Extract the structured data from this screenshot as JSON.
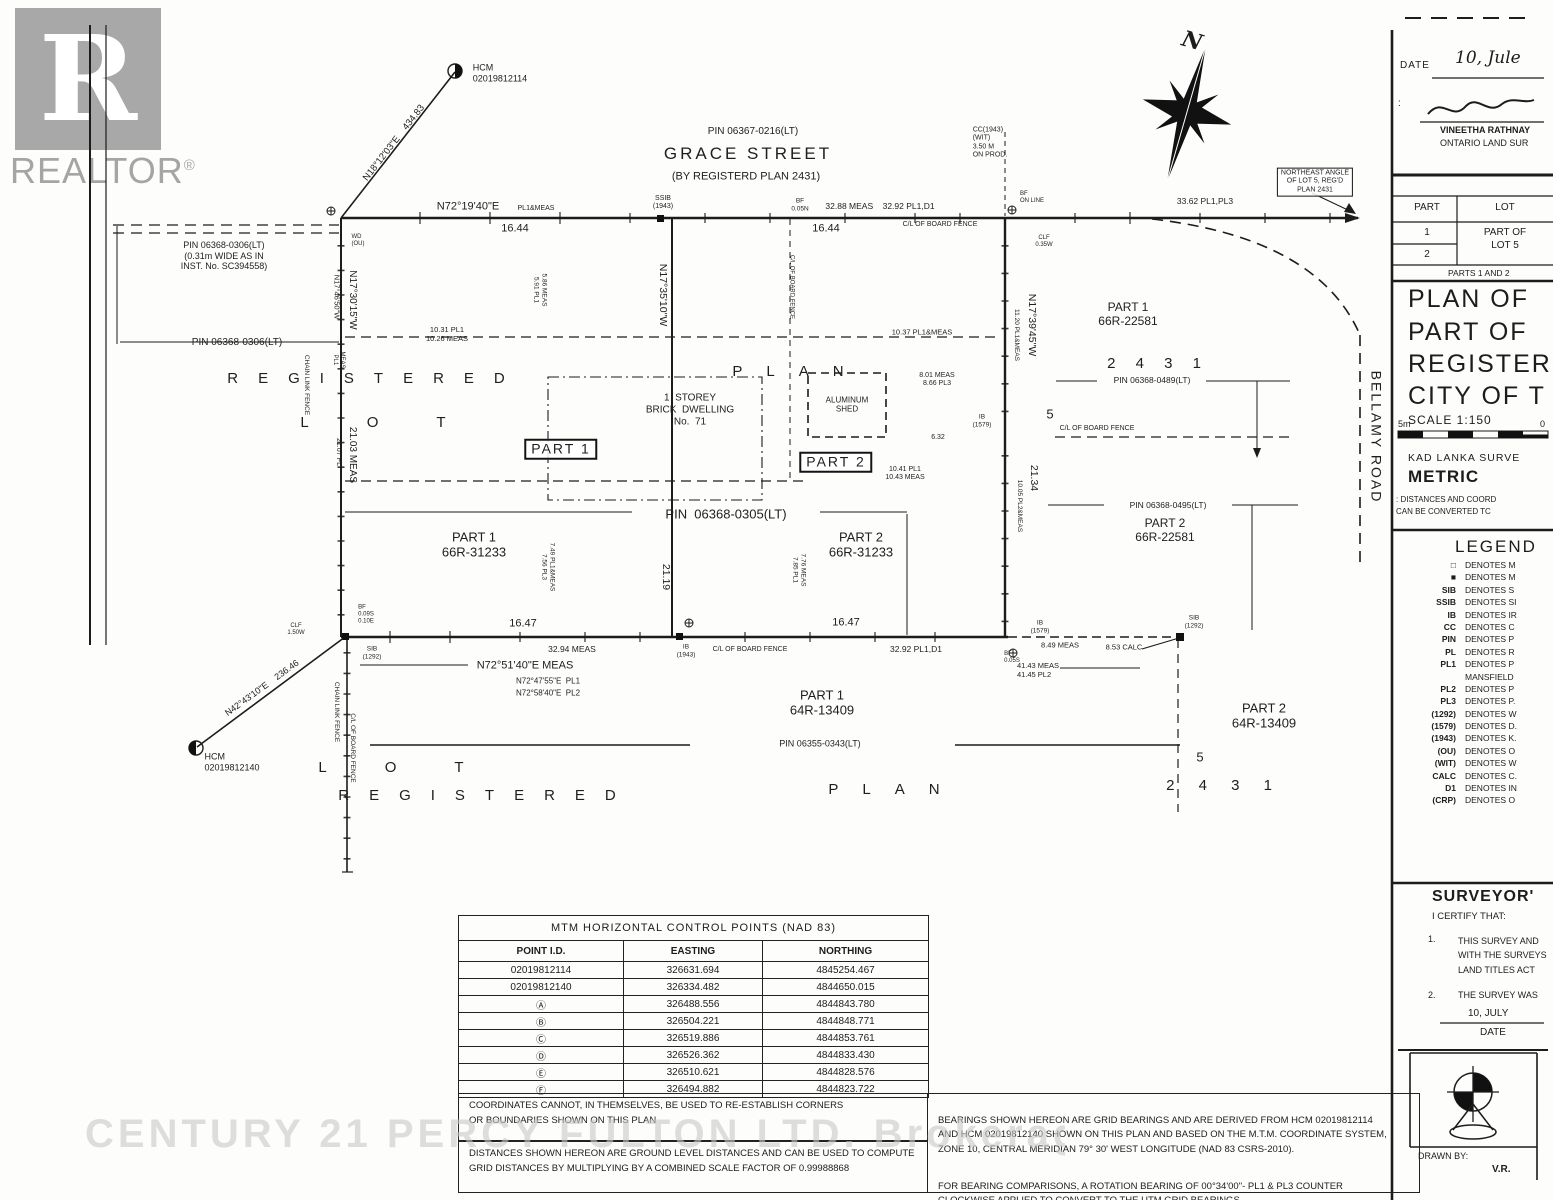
{
  "logo": {
    "r": "R",
    "brand": "REALTOR",
    "reg": "®"
  },
  "compass": {
    "north": "N"
  },
  "watermark": "CENTURY 21 PERCY FULTON LTD. Brokerage",
  "plan": {
    "labels": [
      {
        "name": "hcm-top-label",
        "text": "HCM\n02019812114",
        "x": 500,
        "y": 73,
        "size": 9,
        "align": "left"
      },
      {
        "name": "bearing-n18-12-03",
        "text": "N18°12'03\"E    434.83",
        "x": 394,
        "y": 143,
        "size": 9.5,
        "rot": -52
      },
      {
        "name": "grace-street-pin",
        "text": "PIN 06367-0216(LT)",
        "x": 753,
        "y": 132,
        "size": 10
      },
      {
        "name": "grace-street-name",
        "text": "GRACE STREET",
        "x": 748,
        "y": 154,
        "size": 17,
        "ls": 3
      },
      {
        "name": "grace-street-sub",
        "text": "(BY REGISTERD PLAN 2431)",
        "x": 746,
        "y": 177,
        "size": 11
      },
      {
        "name": "cc-wit-note",
        "text": "CC(1943)\n(WIT)\n3.50 M\nON PROD.",
        "x": 990,
        "y": 143,
        "size": 7,
        "align": "left"
      },
      {
        "name": "northeast-angle-note",
        "text": "NORTHEAST ANGLE\nOF LOT 5, REG'D\nPLAN 2431",
        "x": 1315,
        "y": 182,
        "size": 7,
        "thinbox": true
      },
      {
        "name": "dim-33-62",
        "text": "33.62 PL1,PL3",
        "x": 1205,
        "y": 201,
        "size": 8.5
      },
      {
        "name": "bearing-top-main",
        "text": "N72°19'40\"E",
        "x": 468,
        "y": 207,
        "size": 11
      },
      {
        "name": "bearing-top-suffix",
        "text": "PL1&MEAS",
        "x": 536,
        "y": 209,
        "size": 7
      },
      {
        "name": "dim-16-44-west",
        "text": "16.44",
        "x": 515,
        "y": 229,
        "size": 11
      },
      {
        "name": "ssib-1943-top",
        "text": "SSIB\n(1943)",
        "x": 663,
        "y": 203,
        "size": 7
      },
      {
        "name": "bf-0-05n",
        "text": "BF\n0.05N",
        "x": 800,
        "y": 205,
        "size": 6.5
      },
      {
        "name": "dim-32-88",
        "text": "32.88 MEAS    32.92 PL1,D1",
        "x": 880,
        "y": 206,
        "size": 8.5
      },
      {
        "name": "dim-16-44-east",
        "text": "16.44",
        "x": 826,
        "y": 229,
        "size": 11
      },
      {
        "name": "cl-board-fence-top",
        "text": "C/L OF BOARD FENCE",
        "x": 940,
        "y": 225,
        "size": 7
      },
      {
        "name": "bf-on-line",
        "text": "BF\nON LINE",
        "x": 1032,
        "y": 198,
        "size": 6,
        "align": "left"
      },
      {
        "name": "clf-0-35w",
        "text": "CLF\n0.35W",
        "x": 1044,
        "y": 242,
        "size": 6
      },
      {
        "name": "wd-ou",
        "text": "WD\n(OU)",
        "x": 358,
        "y": 241,
        "size": 6,
        "align": "left"
      },
      {
        "name": "pin-0306-note",
        "text": "PIN 06368-0306(LT)\n(0.31m WIDE AS IN\nINST. No. SC394558)",
        "x": 224,
        "y": 256,
        "size": 9
      },
      {
        "name": "pin-0306-label",
        "text": "PIN 06368-0306(LT)",
        "x": 237,
        "y": 343,
        "size": 10
      },
      {
        "name": "bearing-n17-30-15",
        "text": "N17°30'15\"W",
        "x": 352,
        "y": 300,
        "size": 10,
        "rot": 90
      },
      {
        "name": "bearing-n17-46-50",
        "text": "N17°46'50\"W",
        "x": 336,
        "y": 297,
        "size": 7.5,
        "rot": 90
      },
      {
        "name": "meas-pl1-small",
        "text": "MEAS\nPL1",
        "x": 338,
        "y": 360,
        "size": 6,
        "rot": 90
      },
      {
        "name": "chain-link-fence-upper",
        "text": "CHAIN LINK FENCE",
        "x": 306,
        "y": 385,
        "size": 6.5,
        "rot": 90
      },
      {
        "name": "dim-21-03",
        "text": "21.03 MEAS",
        "x": 352,
        "y": 455,
        "size": 10,
        "rot": 90
      },
      {
        "name": "dim-21-07",
        "text": "21.07 PL",
        "x": 338,
        "y": 452,
        "size": 7,
        "rot": 90
      },
      {
        "name": "registered-upper-spread",
        "text": "REGISTERED",
        "x": 376,
        "y": 379,
        "size": 15,
        "ls": 20
      },
      {
        "name": "lot-upper-spread",
        "text": "LOT",
        "x": 402,
        "y": 423,
        "size": 15,
        "ls": 58
      },
      {
        "name": "dim-10-31",
        "text": "10.31 PL1\n10.26 MEAS",
        "x": 447,
        "y": 335,
        "size": 7.5
      },
      {
        "name": "dim-5-86",
        "text": "5.86 MEAS\n5.91 PL1",
        "x": 540,
        "y": 290,
        "size": 6.5,
        "rot": 90
      },
      {
        "name": "bearing-n17-35-10",
        "text": "N17°35'10\"W",
        "x": 663,
        "y": 295,
        "size": 10.5,
        "rot": 90
      },
      {
        "name": "cl-board-fence-vert",
        "text": "C/L OF BOARD FENCE",
        "x": 791,
        "y": 287,
        "size": 6,
        "rot": 90
      },
      {
        "name": "dwelling-label",
        "text": "1  STOREY\nBRICK  DWELLING\nNo.  71",
        "x": 690,
        "y": 410,
        "size": 10
      },
      {
        "name": "plan-upper-spread",
        "text": "PLAN",
        "x": 800,
        "y": 372,
        "size": 15,
        "ls": 24
      },
      {
        "name": "aluminum-shed-label",
        "text": "ALUMINUM\nSHED",
        "x": 847,
        "y": 405,
        "size": 8
      },
      {
        "name": "dim-10-37",
        "text": "10.37 PL1&MEAS",
        "x": 922,
        "y": 333,
        "size": 7.5
      },
      {
        "name": "dim-8-01",
        "text": "8.01 MEAS\n8.66 PL3",
        "x": 937,
        "y": 380,
        "size": 7
      },
      {
        "name": "ib-1579-mid",
        "text": "IB\n(1579)",
        "x": 982,
        "y": 421,
        "size": 6.5
      },
      {
        "name": "dim-6-32",
        "text": "6.32",
        "x": 938,
        "y": 438,
        "size": 7
      },
      {
        "name": "part1-boxed",
        "text": "PART 1",
        "x": 561,
        "y": 449,
        "size": 14,
        "box": true,
        "ls": 2
      },
      {
        "name": "part2-boxed",
        "text": "PART 2",
        "x": 836,
        "y": 462,
        "size": 14,
        "box": true,
        "ls": 2
      },
      {
        "name": "dim-10-41",
        "text": "10.41 PL1\n10.43 MEAS",
        "x": 905,
        "y": 474,
        "size": 7
      },
      {
        "name": "bearing-n17-39-45",
        "text": "N17°39'45\"W",
        "x": 1032,
        "y": 325,
        "size": 10.5,
        "rot": 90
      },
      {
        "name": "dim-11-20",
        "text": "11.20 PL1&MEAS",
        "x": 1016,
        "y": 335,
        "size": 6.5,
        "rot": 90
      },
      {
        "name": "part1-66r-22581",
        "text": "PART 1\n66R-22581",
        "x": 1128,
        "y": 314,
        "size": 12
      },
      {
        "name": "plan-2431-upper",
        "text": "2 4 3 1",
        "x": 1158,
        "y": 364,
        "size": 15,
        "ls": 8
      },
      {
        "name": "pin-0489",
        "text": "PIN 06368-0489(LT)",
        "x": 1152,
        "y": 380,
        "size": 8.5
      },
      {
        "name": "lot-5-upper",
        "text": "5",
        "x": 1050,
        "y": 414,
        "size": 13
      },
      {
        "name": "cl-board-fence-right",
        "text": "C/L OF BOARD FENCE",
        "x": 1097,
        "y": 429,
        "size": 7
      },
      {
        "name": "dim-21-34",
        "text": "21.34",
        "x": 1034,
        "y": 478,
        "size": 10.5,
        "rot": 90
      },
      {
        "name": "dim-10-05",
        "text": "10.05 PL2&MEAS",
        "x": 1019,
        "y": 506,
        "size": 6.5,
        "rot": 90
      },
      {
        "name": "pin-0495",
        "text": "PIN 06368-0495(LT)",
        "x": 1168,
        "y": 505,
        "size": 8.5
      },
      {
        "name": "part2-66r-22581",
        "text": "PART 2\n66R-22581",
        "x": 1165,
        "y": 530,
        "size": 12
      },
      {
        "name": "bellamy-road",
        "text": "BELLAMY ROAD",
        "x": 1376,
        "y": 437,
        "size": 14,
        "rot": 90,
        "ls": 2
      },
      {
        "name": "part1-66r-31233",
        "text": "PART 1\n66R-31233",
        "x": 474,
        "y": 545,
        "size": 13
      },
      {
        "name": "dim-7-49",
        "text": "7.49 PL1&MEAS\n7.56 PL3",
        "x": 548,
        "y": 567,
        "size": 6.5,
        "rot": 90
      },
      {
        "name": "pin-0305",
        "text": "PIN  06368-0305(LT)",
        "x": 726,
        "y": 514,
        "size": 13
      },
      {
        "name": "part2-66r-31233",
        "text": "PART 2\n66R-31233",
        "x": 861,
        "y": 545,
        "size": 13
      },
      {
        "name": "dim-7-76",
        "text": "7.76 MEAS\n7.85 PL1",
        "x": 799,
        "y": 570,
        "size": 6.5,
        "rot": 90
      },
      {
        "name": "dim-21-19",
        "text": "21.19",
        "x": 666,
        "y": 577,
        "size": 10.5,
        "rot": 90
      },
      {
        "name": "bf-0-09s",
        "text": "BF\n0.09S\n0.10E",
        "x": 366,
        "y": 615,
        "size": 6,
        "align": "left"
      },
      {
        "name": "clf-1-50w",
        "text": "CLF\n1.50W",
        "x": 296,
        "y": 630,
        "size": 6
      },
      {
        "name": "dim-16-47-west",
        "text": "16.47",
        "x": 523,
        "y": 624,
        "size": 11
      },
      {
        "name": "dim-32-94",
        "text": "32.94 MEAS",
        "x": 572,
        "y": 649,
        "size": 8.5
      },
      {
        "name": "ib-1943-bottom",
        "text": "IB\n(1943)",
        "x": 686,
        "y": 651,
        "size": 6.5
      },
      {
        "name": "cl-board-fence-bottom",
        "text": "C/L OF BOARD FENCE",
        "x": 750,
        "y": 650,
        "size": 7
      },
      {
        "name": "dim-16-47-east",
        "text": "16.47",
        "x": 846,
        "y": 623,
        "size": 11
      },
      {
        "name": "dim-32-92b",
        "text": "32.92 PL1,D1",
        "x": 916,
        "y": 649,
        "size": 8.5
      },
      {
        "name": "ib-1579-bottom",
        "text": "IB\n(1579)",
        "x": 1040,
        "y": 627,
        "size": 6.5
      },
      {
        "name": "sib-1292-bottom",
        "text": "SIB\n(1292)",
        "x": 1194,
        "y": 622,
        "size": 6.5
      },
      {
        "name": "dim-8-49",
        "text": "8.49 MEAS",
        "x": 1060,
        "y": 646,
        "size": 7.5
      },
      {
        "name": "dim-8-53",
        "text": "8.53 CALC",
        "x": 1124,
        "y": 648,
        "size": 7.5
      },
      {
        "name": "bf-0-05s",
        "text": "BF\n0.05S",
        "x": 1012,
        "y": 658,
        "size": 6,
        "align": "left"
      },
      {
        "name": "dim-41-43",
        "text": "41.43 MEAS\n41.45 PL2",
        "x": 1038,
        "y": 671,
        "size": 7.5,
        "align": "left"
      },
      {
        "name": "bearing-bottom-meas",
        "text": "N72°51'40\"E MEAS",
        "x": 525,
        "y": 666,
        "size": 11
      },
      {
        "name": "bearing-bottom-pl1",
        "text": "N72°47'55\"E  PL1",
        "x": 548,
        "y": 681,
        "size": 8
      },
      {
        "name": "bearing-bottom-pl2",
        "text": "N72°58'40\"E  PL2",
        "x": 548,
        "y": 693,
        "size": 8
      },
      {
        "name": "sib-1292-corner",
        "text": "SIB\n(1292)",
        "x": 372,
        "y": 653,
        "size": 6.5
      },
      {
        "name": "hcm-bottom-label",
        "text": "HCM\n02019812140",
        "x": 232,
        "y": 762,
        "size": 9,
        "align": "left"
      },
      {
        "name": "bearing-n42-43-10",
        "text": "N42°43'10\"E    236.46",
        "x": 262,
        "y": 688,
        "size": 9,
        "rot": -36
      },
      {
        "name": "chain-link-fence-lower",
        "text": "CHAIN LINK FENCE",
        "x": 336,
        "y": 712,
        "size": 6.5,
        "rot": 90
      },
      {
        "name": "cl-board-fence-lower",
        "text": "C/L OF BOARD FENCE",
        "x": 352,
        "y": 748,
        "size": 6.5,
        "rot": 90
      },
      {
        "name": "part1-64r-13409",
        "text": "PART 1\n64R-13409",
        "x": 822,
        "y": 703,
        "size": 13
      },
      {
        "name": "pin-0343",
        "text": "PIN 06355-0343(LT)",
        "x": 820,
        "y": 744,
        "size": 9
      },
      {
        "name": "part2-64r-13409",
        "text": "PART 2\n64R-13409",
        "x": 1264,
        "y": 716,
        "size": 13
      },
      {
        "name": "lot-5-lower",
        "text": "5",
        "x": 1200,
        "y": 757,
        "size": 13
      },
      {
        "name": "plan-2431-lower",
        "text": "2 4 3 1",
        "x": 1224,
        "y": 786,
        "size": 15,
        "ls": 10
      },
      {
        "name": "lot-lower-spread",
        "text": "LOT",
        "x": 420,
        "y": 768,
        "size": 15,
        "ls": 58
      },
      {
        "name": "registered-lower-spread",
        "text": "REGISTERED",
        "x": 487,
        "y": 796,
        "size": 15,
        "ls": 20
      },
      {
        "name": "plan-lower-spread",
        "text": "PLAN",
        "x": 896,
        "y": 790,
        "size": 15,
        "ls": 24
      }
    ]
  },
  "title_block": {
    "date_label": "DATE",
    "date_value": "10, Jule",
    "surveyor_name": "VINEETHA RATHNAY",
    "surveyor_title": "ONTARIO LAND SUR",
    "colon": ":",
    "schedule": {
      "col1": "PART",
      "col2": "LOT",
      "row1": "1",
      "row2": "2",
      "lot_value": "PART OF\nLOT 5",
      "footer": "PARTS 1 AND 2"
    },
    "title_line1": "PLAN OF",
    "title_line2": "PART OF",
    "title_line3": "REGISTERI",
    "title_line4": "CITY OF T",
    "scale": "SCALE 1:150",
    "scale_left": "5m",
    "scale_right": "0",
    "firm": "KAD LANKA SURVE",
    "metric": "METRIC",
    "metric_note": ": DISTANCES AND COORD\nCAN BE CONVERTED TC",
    "certificate": {
      "title": "SURVEYOR'",
      "certify": "I CERTIFY THAT:",
      "item1_no": "1.",
      "item1": "THIS SURVEY AND\nWITH THE SURVEYS\nLAND TITLES ACT",
      "item2_no": "2.",
      "item2": "THE SURVEY WAS",
      "date_value": "10, JULY",
      "date_label": "DATE"
    },
    "drawn_by_label": "DRAWN BY:",
    "drawn_by_value": "V.R."
  },
  "legend": {
    "title": "LEGEND",
    "entries": [
      {
        "symbol": "□",
        "text": "DENOTES M"
      },
      {
        "symbol": "■",
        "text": "DENOTES M"
      },
      {
        "symbol": "SIB",
        "text": "DENOTES S"
      },
      {
        "symbol": "SSIB",
        "text": "DENOTES SI"
      },
      {
        "symbol": "IB",
        "text": "DENOTES IR"
      },
      {
        "symbol": "CC",
        "text": "DENOTES C"
      },
      {
        "symbol": "PIN",
        "text": "DENOTES P"
      },
      {
        "symbol": "PL",
        "text": "DENOTES R"
      },
      {
        "symbol": "PL1",
        "text": "DENOTES P"
      },
      {
        "symbol": "",
        "text": "MANSFIELD"
      },
      {
        "symbol": "PL2",
        "text": "DENOTES P"
      },
      {
        "symbol": "PL3",
        "text": "DENOTES P."
      },
      {
        "symbol": "(1292)",
        "text": "DENOTES W"
      },
      {
        "symbol": "(1579)",
        "text": "DENOTES D."
      },
      {
        "symbol": "(1943)",
        "text": "DENOTES K."
      },
      {
        "symbol": "(OU)",
        "text": "DENOTES O"
      },
      {
        "symbol": "(WIT)",
        "text": "DENOTES W"
      },
      {
        "symbol": "CALC",
        "text": "DENOTES C."
      },
      {
        "symbol": "D1",
        "text": "DENOTES IN"
      },
      {
        "symbol": "(CRP)",
        "text": "DENOTES O"
      }
    ]
  },
  "control_points_table": {
    "title": "MTM HORIZONTAL CONTROL POINTS (NAD 83)",
    "headers": [
      "POINT I.D.",
      "EASTING",
      "NORTHING"
    ],
    "rows": [
      [
        "02019812114",
        "326631.694",
        "4845254.467"
      ],
      [
        "02019812140",
        "326334.482",
        "4844650.015"
      ],
      [
        "Ⓐ",
        "326488.556",
        "4844843.780"
      ],
      [
        "Ⓑ",
        "326504.221",
        "4844848.771"
      ],
      [
        "Ⓒ",
        "326519.886",
        "4844853.761"
      ],
      [
        "Ⓓ",
        "326526.362",
        "4844833.430"
      ],
      [
        "Ⓔ",
        "326510.621",
        "4844828.576"
      ],
      [
        "Ⓕ",
        "326494.882",
        "4844823.722"
      ]
    ]
  },
  "notes": {
    "coordinates_note": "COORDINATES CANNOT, IN THEMSELVES, BE USED TO RE-ESTABLISH CORNERS\nOR BOUNDARIES SHOWN ON THIS PLAN",
    "distances_note": "DISTANCES SHOWN HEREON ARE GROUND LEVEL DISTANCES AND CAN BE USED TO COMPUTE\nGRID DISTANCES BY MULTIPLYING BY A COMBINED SCALE FACTOR OF 0.99988868",
    "bearings_note": "BEARINGS SHOWN HEREON ARE GRID BEARINGS AND ARE DERIVED FROM HCM 02019812114\nAND HCM 02019812140 SHOWN ON THIS PLAN AND BASED ON THE M.T.M. COORDINATE SYSTEM,\nZONE 10, CENTRAL MERIDIAN 79° 30' WEST LONGITUDE (NAD 83 CSRS-2010).",
    "rotation_note": "FOR BEARING COMPARISONS, A ROTATION BEARING OF 00°34'00\"- PL1 & PL3 COUNTER\nCLOCKWISE APPLIED TO CONVERT TO THE UTM GRID BEARINGS."
  }
}
